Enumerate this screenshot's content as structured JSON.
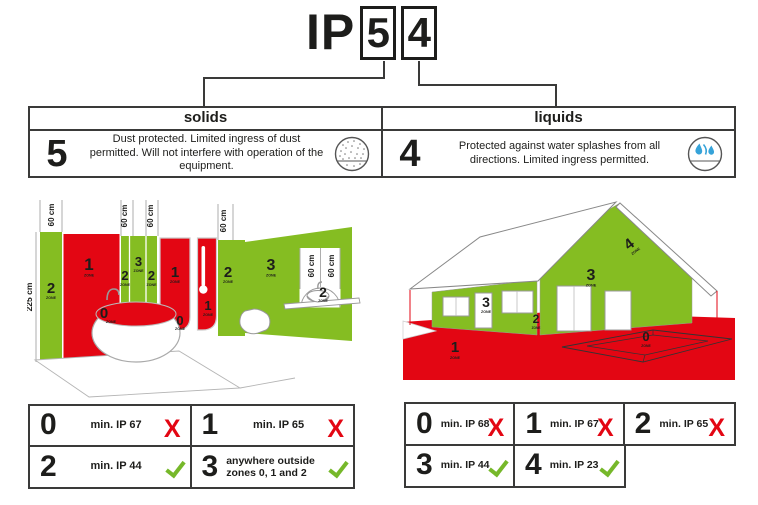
{
  "title": {
    "prefix": "IP",
    "solids_digit": "5",
    "liquids_digit": "4"
  },
  "ratings": {
    "solids": {
      "header": "solids",
      "digit": "5",
      "description": "Dust protected. Limited ingress of dust permitted. Will not interfere with operation of the equipment.",
      "icon": "dust-protection-icon"
    },
    "liquids": {
      "header": "liquids",
      "digit": "4",
      "description": "Protected against water splashes from all directions. Limited ingress permitted.",
      "icon": "water-splash-icon"
    }
  },
  "labels": {
    "zone": "ZONE",
    "cm60": "60 cm",
    "cm225": "225 cm"
  },
  "digits": {
    "d0": "0",
    "d1": "1",
    "d2": "2",
    "d3": "3",
    "d4": "4"
  },
  "bathroom_table": {
    "rows": [
      [
        {
          "zone": "0",
          "text": "min. IP 67",
          "status": "fail"
        },
        {
          "zone": "1",
          "text": "min. IP 65",
          "status": "fail"
        }
      ],
      [
        {
          "zone": "2",
          "text": "min. IP 44",
          "status": "pass"
        },
        {
          "zone": "3",
          "text": "anywhere outside zones 0, 1 and 2",
          "status": "pass"
        }
      ]
    ]
  },
  "outdoor_table": {
    "rows": [
      [
        {
          "zone": "0",
          "text": "min. IP 68",
          "status": "fail"
        },
        {
          "zone": "1",
          "text": "min. IP 67",
          "status": "fail"
        },
        {
          "zone": "2",
          "text": "min. IP 65",
          "status": "fail"
        }
      ],
      [
        {
          "zone": "3",
          "text": "min. IP 44",
          "status": "pass"
        },
        {
          "zone": "4",
          "text": "min. IP 23",
          "status": "pass"
        }
      ]
    ]
  },
  "marks": {
    "fail_glyph": "X",
    "pass_icon": "check-mark"
  },
  "colors": {
    "red": "#e30613",
    "green": "#85bd22",
    "blue": "#36a3d9",
    "border": "#3a3a39",
    "check_green": "#76b82a"
  }
}
